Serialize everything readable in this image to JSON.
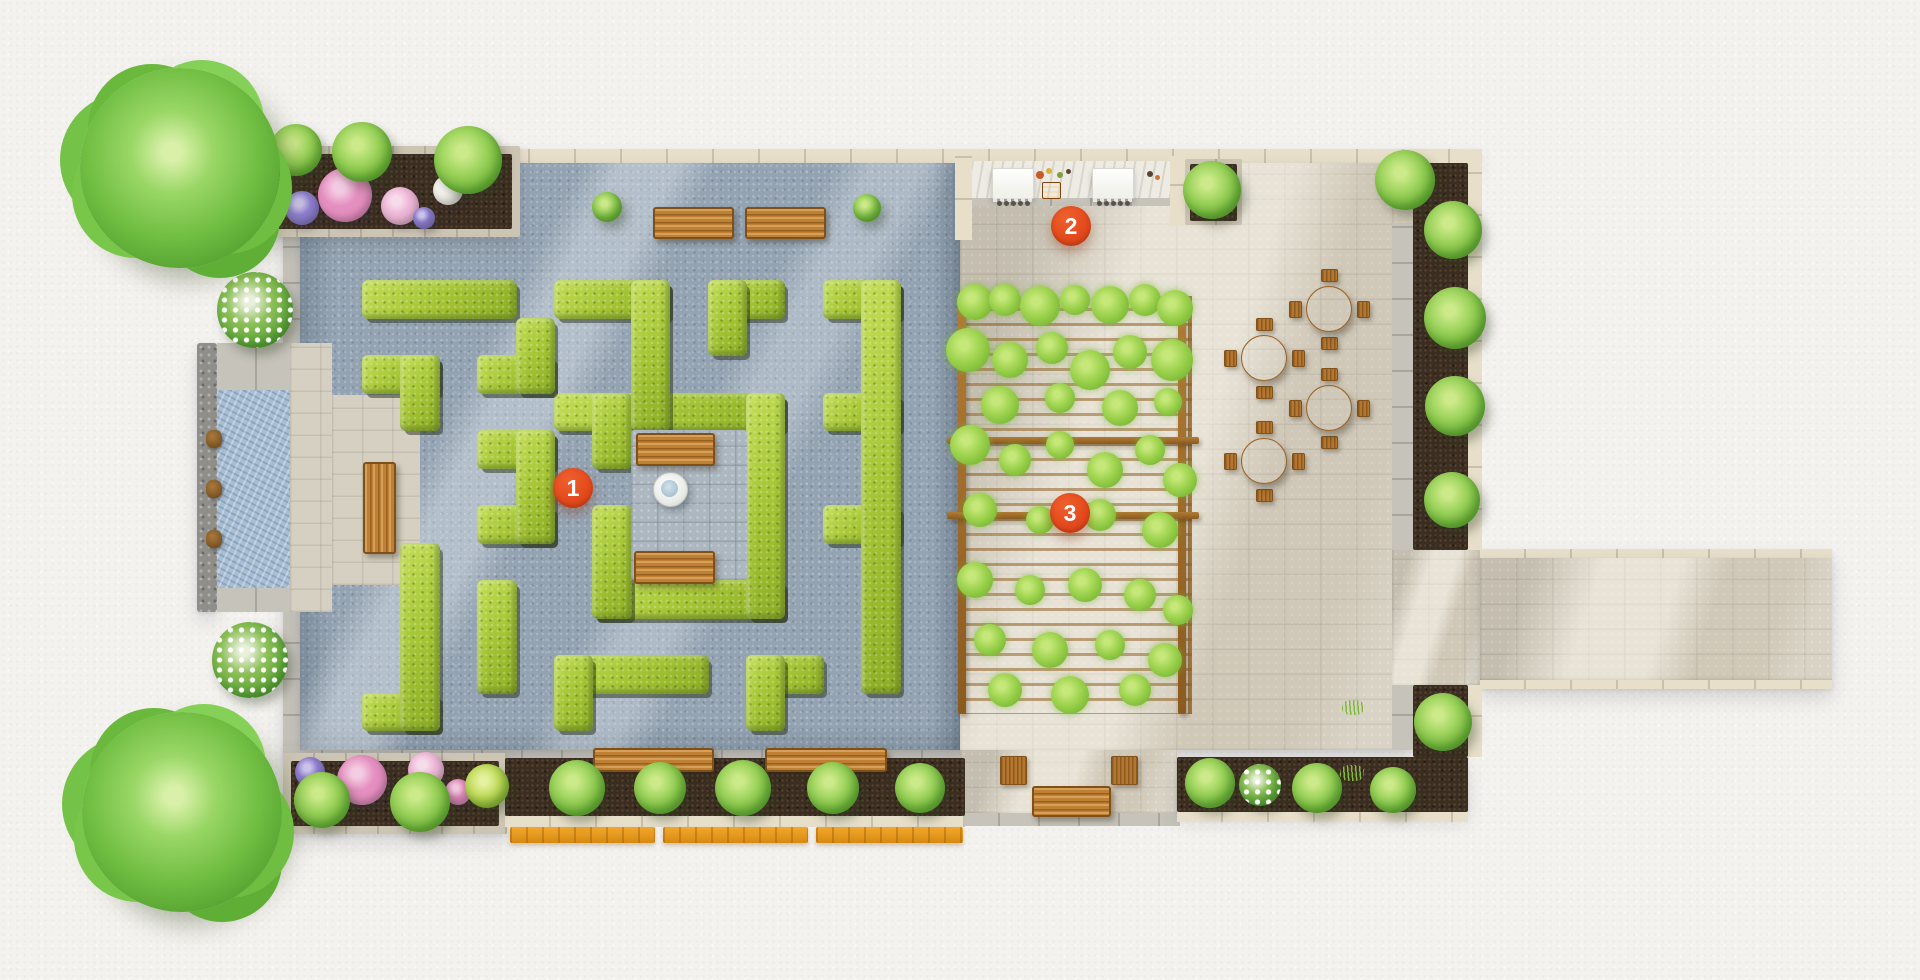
{
  "plan": {
    "type": "courtyard-garden-top-view-plan",
    "canvas": {
      "width": 1920,
      "height": 980
    }
  },
  "markers": [
    {
      "label": "1",
      "x": 573,
      "y": 488
    },
    {
      "label": "2",
      "x": 1071,
      "y": 226
    },
    {
      "label": "3",
      "x": 1070,
      "y": 513
    }
  ],
  "maze": {
    "origin": {
      "x": 362,
      "y": 280
    },
    "cell": {
      "w": 38.4,
      "h": 37.5
    },
    "grid": [
      "####.###.##.##",
      "....#..#.#...#",
      "##.##..#.....#",
      ".#...######.##",
      "...##.#...#..#",
      "....#.....#..#",
      "...##.#...#.##",
      ".#....#...#..#",
      ".#.#..#####..#",
      ".#.#.........#",
      ".#.#.####.##.#",
      "##...#....#..."
    ]
  },
  "palette": {
    "paper": "#f4f2ef",
    "gravel": "#94a3b2",
    "hedge": "#a6c636",
    "patio_pavers": "#cfc9bb",
    "cream_edge": "#e7dfca",
    "soil": "#3a2d21",
    "water": "#a7bed4",
    "wood": "#c08033",
    "boardwalk": "#eda31f",
    "marker": "#e2491c",
    "tree": "#6fbd41"
  }
}
